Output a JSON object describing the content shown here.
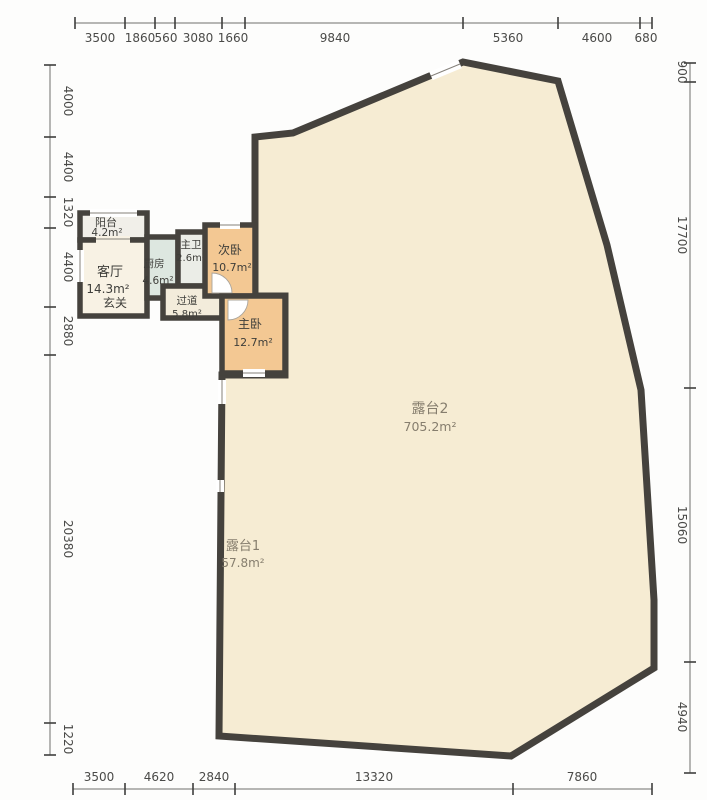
{
  "dimensions": {
    "top": [
      "3500",
      "1860",
      "560",
      "3080",
      "1660",
      "9840",
      "5360",
      "4600",
      "680"
    ],
    "left": [
      "4000",
      "4400",
      "1320",
      "4400",
      "2880",
      "20380",
      "1220"
    ],
    "right": [
      "900",
      "17700",
      "15060",
      "4940"
    ],
    "bottom": [
      "3500",
      "4620",
      "2840",
      "13320",
      "7860"
    ]
  },
  "rooms": {
    "balcony": {
      "name": "阳台",
      "area": "4.2m²"
    },
    "living_room": {
      "name": "客厅",
      "area": "14.3m²"
    },
    "foyer": {
      "name": "玄关"
    },
    "kitchen": {
      "name": "厨房",
      "area": "4.6m²"
    },
    "master_bath": {
      "name": "主卫",
      "area": "2.6m²"
    },
    "hallway": {
      "name": "过道",
      "area": "5.8m²"
    },
    "bedroom2": {
      "name": "次卧",
      "area": "10.7m²"
    },
    "master_bedroom": {
      "name": "主卧",
      "area": "12.7m²"
    },
    "terrace2": {
      "name": "露台2",
      "area": "705.2m²"
    },
    "terrace1": {
      "name": "露台1",
      "area": "57.8m²"
    }
  },
  "colors": {
    "wall": "#45423d",
    "terrace_floor": "#f6ecd3",
    "bedroom_floor": "#f3c893",
    "kitchen_floor": "#dde7e0",
    "bath_floor": "#ebede7",
    "hallway_floor": "#f3ecdb",
    "living_floor": "#f8f2e4",
    "balcony_floor": "#f1efe9",
    "dimension_text": "#4a4a48"
  }
}
